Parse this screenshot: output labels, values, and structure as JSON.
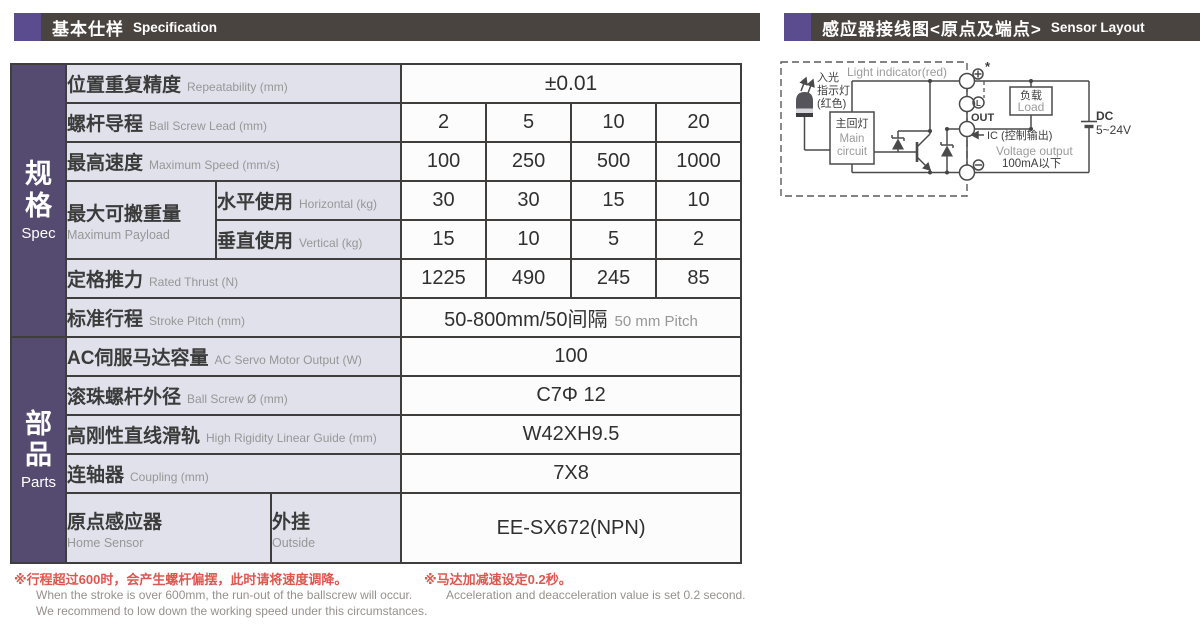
{
  "colors": {
    "accent": "#5a4c8f",
    "sidebar": "#554a70",
    "headerBg": "#4a4440",
    "labelBg": "#e0e1eb",
    "border": "#403e3d",
    "noteRed": "#dd574f",
    "noteGray": "#97908d"
  },
  "headers": {
    "left_zh": "基本仕样",
    "left_en": "Specification",
    "right_zh": "感应器接线图<原点及端点>",
    "right_en": "Sensor Layout"
  },
  "sidebar": {
    "spec_zh": "规格",
    "spec_en": "Spec",
    "parts_zh": "部品",
    "parts_en": "Parts"
  },
  "table": {
    "repeatability": {
      "zh": "位置重复精度",
      "en": "Repeatability (mm)",
      "value": "±0.01"
    },
    "lead": {
      "zh": "螺杆导程",
      "en": "Ball Screw Lead (mm)",
      "values": [
        "2",
        "5",
        "10",
        "20"
      ]
    },
    "speed": {
      "zh": "最高速度",
      "en": "Maximum Speed (mm/s)",
      "values": [
        "100",
        "250",
        "500",
        "1000"
      ]
    },
    "payload": {
      "zh": "最大可搬重量",
      "en": "Maximum Payload"
    },
    "horizontal": {
      "zh": "水平使用",
      "en": "Horizontal (kg)",
      "values": [
        "30",
        "30",
        "15",
        "10"
      ]
    },
    "vertical": {
      "zh": "垂直使用",
      "en": "Vertical (kg)",
      "values": [
        "15",
        "10",
        "5",
        "2"
      ]
    },
    "thrust": {
      "zh": "定格推力",
      "en": "Rated Thrust (N)",
      "values": [
        "1225",
        "490",
        "245",
        "85"
      ]
    },
    "stroke": {
      "zh": "标准行程",
      "en": "Stroke Pitch (mm)",
      "value_zh": "50-800mm/50间隔",
      "value_en": "50 mm Pitch"
    },
    "motor": {
      "zh": "AC伺服马达容量",
      "en": "AC Servo Motor Output (W)",
      "value": "100"
    },
    "screw_od": {
      "zh": "滚珠螺杆外径",
      "en": "Ball Screw Ø (mm)",
      "value": "C7Φ 12"
    },
    "guide": {
      "zh": "高刚性直线滑轨",
      "en": "High Rigidity Linear Guide (mm)",
      "value": "W42XH9.5"
    },
    "coupling": {
      "zh": "连轴器",
      "en": "Coupling (mm)",
      "value": "7X8"
    },
    "home_sensor": {
      "zh": "原点感应器",
      "en": "Home Sensor"
    },
    "outside": {
      "zh": "外挂",
      "en": "Outside",
      "value": "EE-SX672(NPN)"
    }
  },
  "notes": {
    "n1_zh": "※行程超过600时，会产生螺杆偏摆，此时请将速度调降。",
    "n1_en1": "When the stroke is over 600mm, the run-out of the ballscrew will occur.",
    "n1_en2": "We recommend to low down the working speed under this circumstances.",
    "n2_zh": "※马达加减速设定0.2秒。",
    "n2_en": "Acceleration and deacceleration value is set 0.2 second."
  },
  "diagram": {
    "light_indicator": "Light indicator(red)",
    "led1": "入光",
    "led2": "指示灯",
    "led3": "(红色)",
    "main_zh": "主回灯",
    "main_en1": "Main",
    "main_en2": "circuit",
    "out_label": "OUT",
    "star": "*",
    "l_label": "L",
    "ic_label": "IC (控制输出)",
    "voltage": "Voltage output",
    "current": "100mA以下",
    "load_zh": "负载",
    "load_en": "Load",
    "dc1": "DC",
    "dc2": "5~24V"
  }
}
